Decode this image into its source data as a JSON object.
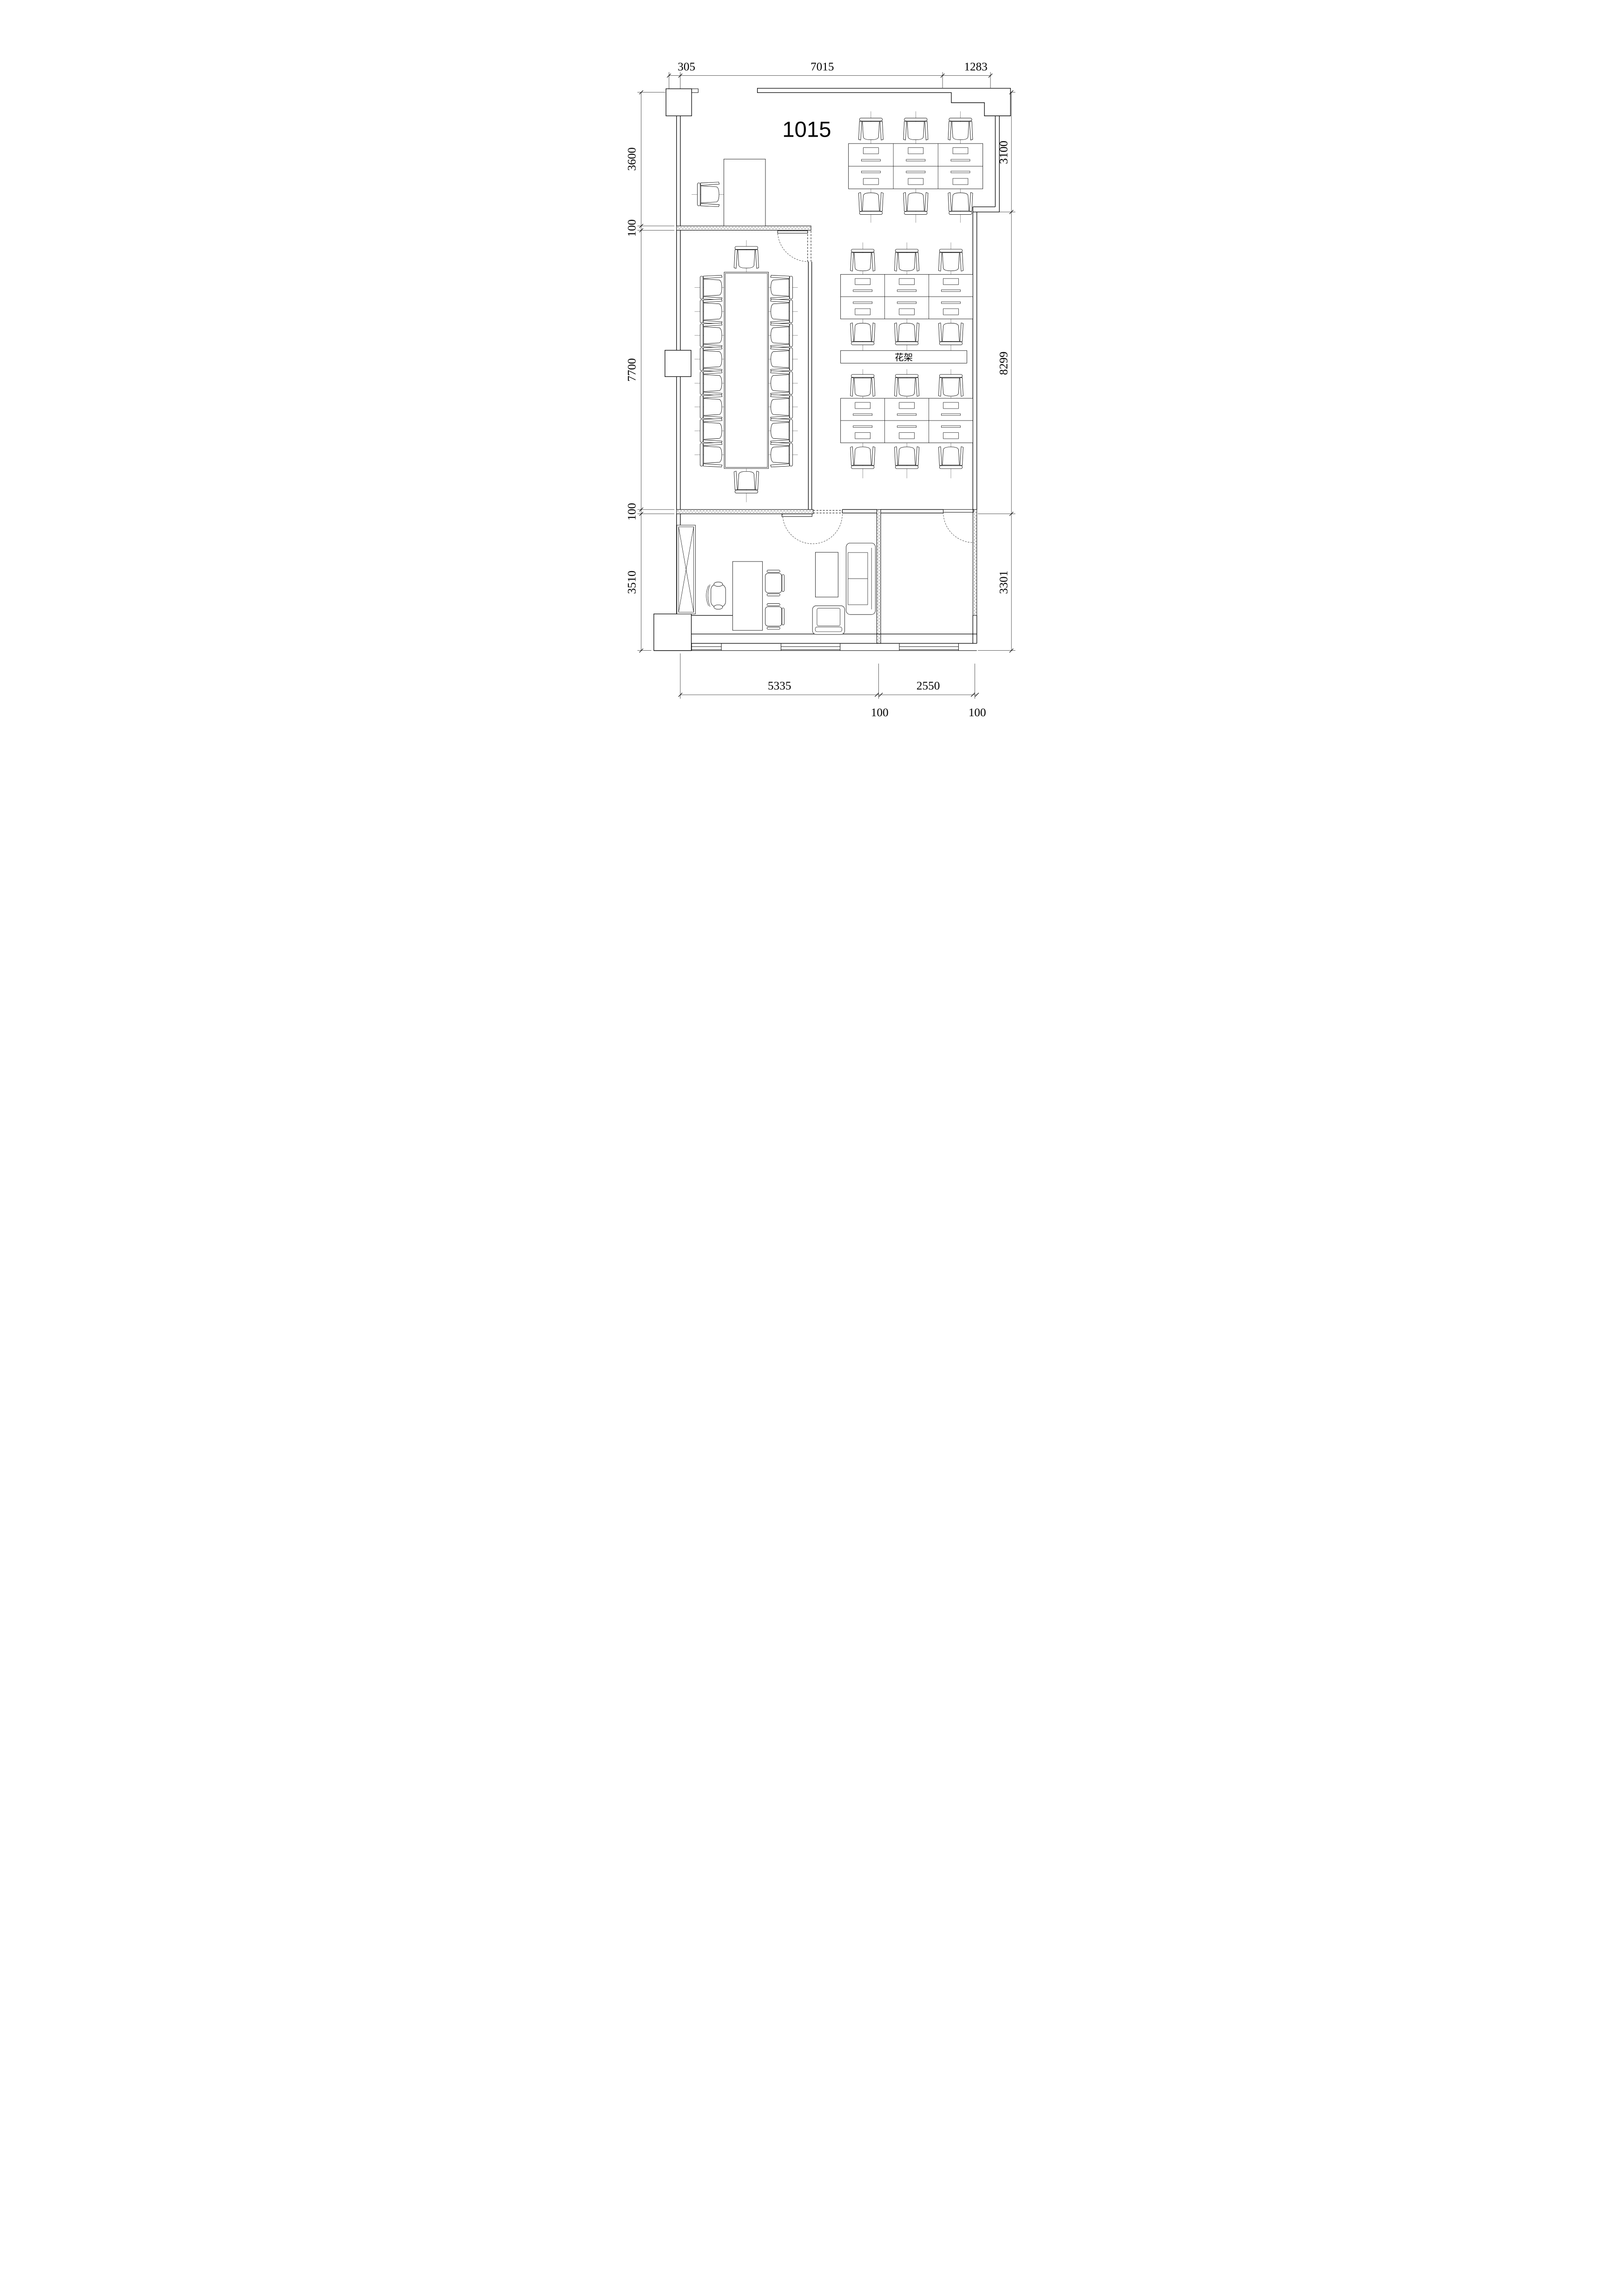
{
  "title": "1015",
  "labels": {
    "flower_rack": "花架"
  },
  "dimensions": {
    "top": [
      "305",
      "7015",
      "1283"
    ],
    "left": [
      "3600",
      "100",
      "7700",
      "100",
      "3510"
    ],
    "right": [
      "3100",
      "8299",
      "3301"
    ],
    "bottom": [
      "5335",
      "2550"
    ],
    "bottom_walls": [
      "100",
      "100"
    ]
  }
}
